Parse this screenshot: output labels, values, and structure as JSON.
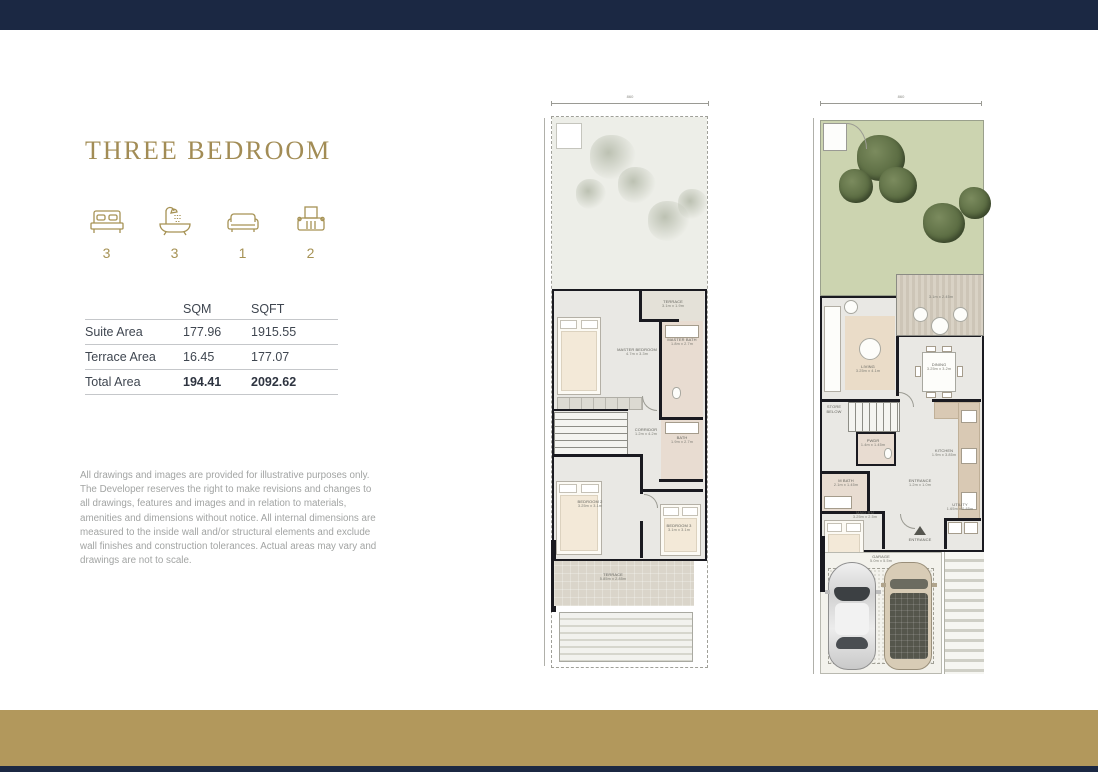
{
  "page": {
    "title": "THREE BEDROOM",
    "colors": {
      "accent_gold": "#b2985c",
      "navy": "#1b2843",
      "garden_green": "#ccd4b0"
    }
  },
  "features": [
    {
      "icon": "bed-icon",
      "count": "3"
    },
    {
      "icon": "bath-icon",
      "count": "3"
    },
    {
      "icon": "sofa-icon",
      "count": "1"
    },
    {
      "icon": "car-icon",
      "count": "2"
    }
  ],
  "area_table": {
    "columns": [
      "SQM",
      "SQFT"
    ],
    "rows": [
      {
        "label": "Suite Area",
        "sqm": "177.96",
        "sqft": "1915.55"
      },
      {
        "label": "Terrace Area",
        "sqm": "16.45",
        "sqft": "177.07"
      },
      {
        "label": "Total Area",
        "sqm": "194.41",
        "sqft": "2092.62"
      }
    ]
  },
  "disclaimer": "All drawings and images are provided for illustrative purposes only. The Developer reserves the right to make revisions and changes to all drawings, features and images and in relation to materials, amenities and dimensions without notice. All internal dimensions are measured to the inside wall and/or structural elements and exclude wall finishes and construction tolerances. Actual areas may vary and drawings are not to scale.",
  "plans": {
    "first_floor": {
      "top_dimension": "860",
      "rooms": [
        {
          "name": "TERRACE",
          "dims": "3.1m x 1.9m"
        },
        {
          "name": "MASTER BEDROOM",
          "dims": "4.7m x 3.3m"
        },
        {
          "name": "MASTER BATH",
          "dims": "1.8m x 2.7m"
        },
        {
          "name": "CORRIDOR",
          "dims": "1.2m x 4.2m"
        },
        {
          "name": "BATH",
          "dims": "1.9m x 2.7m"
        },
        {
          "name": "BEDROOM 2",
          "dims": "3.25m x 3.1m"
        },
        {
          "name": "BEDROOM 3",
          "dims": "3.1m x 3.1m"
        },
        {
          "name": "TERRACE",
          "dims": "5.85m x 2.85m"
        }
      ]
    },
    "ground_floor": {
      "top_dimension": "860",
      "rooms": [
        {
          "name": "",
          "dims": "3.1m x 2.45m"
        },
        {
          "name": "LIVING",
          "dims": "3.25m x 4.1m"
        },
        {
          "name": "DINING",
          "dims": "3.25m x 3.2m"
        },
        {
          "name": "STORE BELOW",
          "dims": ""
        },
        {
          "name": "PWDR",
          "dims": "1.4m x 1.45m"
        },
        {
          "name": "KITCHEN",
          "dims": "1.9m x 3.85m"
        },
        {
          "name": "ENTRANCE",
          "dims": "1.2m x 1.0m"
        },
        {
          "name": "M BATH",
          "dims": "2.1m x 1.45m"
        },
        {
          "name": "MAID RM",
          "dims": "3.25m x 2.5m"
        },
        {
          "name": "UTILITY",
          "dims": "1.65m x 0.85m"
        },
        {
          "name": "ENTRANCE",
          "dims": ""
        },
        {
          "name": "GARAGE",
          "dims": "5.0m x 5.5m"
        }
      ]
    }
  }
}
